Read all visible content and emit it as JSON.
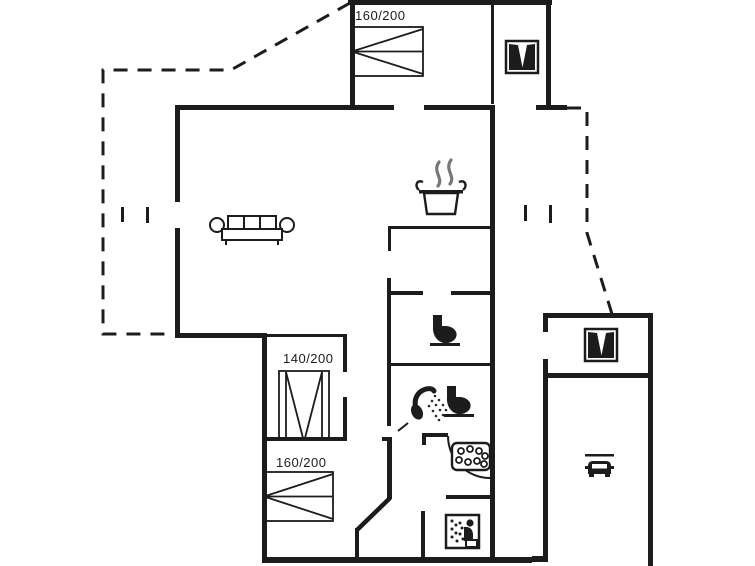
{
  "canvas": {
    "background": "#ffffff",
    "line_color": "#1c1c1c"
  },
  "bed_labels": [
    {
      "room": "bedroom-top",
      "text": "160/200"
    },
    {
      "room": "bedroom-middle",
      "text": "140/200"
    },
    {
      "room": "bedroom-bottom",
      "text": "160/200"
    }
  ],
  "icons": [
    {
      "name": "wardrobe-icon",
      "location": "top-hall"
    },
    {
      "name": "cooking-pot-icon",
      "location": "kitchen"
    },
    {
      "name": "sofa-icon",
      "location": "living-room"
    },
    {
      "name": "toilet-icon",
      "location": "wc"
    },
    {
      "name": "shower-icon",
      "location": "bathroom"
    },
    {
      "name": "toilet-icon",
      "location": "bathroom"
    },
    {
      "name": "whirlpool-icon",
      "location": "utility-room"
    },
    {
      "name": "sauna-icon",
      "location": "sauna"
    },
    {
      "name": "wardrobe-icon",
      "location": "annex-room"
    },
    {
      "name": "car-icon",
      "location": "carport"
    }
  ]
}
